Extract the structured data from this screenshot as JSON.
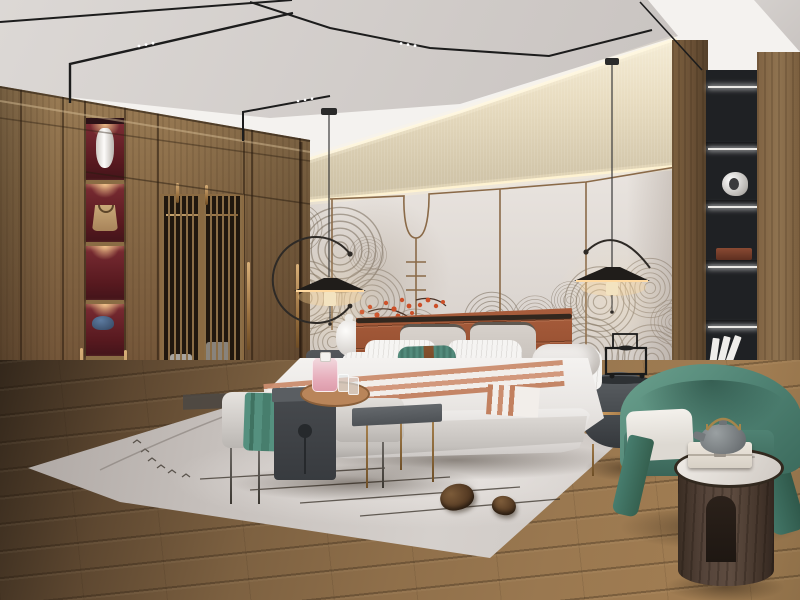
{
  "meta": {
    "domain": "Natural-Image",
    "scene": "Modern new-Chinese style bedroom interior rendering, wide-angle view",
    "no_visible_text": true
  },
  "labels": {
    "room": "Bedroom interior",
    "ceiling": "White and grey ceiling with black magnetic track lights and LED dots",
    "wardrobe": "Walnut wardrobe wall with lattice sliding doors and lit red display niche",
    "feature_wall": "Headboard feature wall: beige textured band, grey panels, brass trim with U-drop, wave mural",
    "right_shelf": "Black built-in display shelving with LED strips",
    "right_pillar": "Walnut wood pillar panels",
    "bed": "Upholstered platform bed with caramel leather channel headboard",
    "pillows": "Layered pillows: taupe, white pinstripe, teal lumbar with leather strap, white bolster",
    "runner": "Salmon and white striped bed runner",
    "nightstand_left": "Dark grey nightstand with white gourd vase lamp",
    "nightstand_right": "Oval dark grey nightstand with brass pull and black wire decor cart",
    "bench": "Bed-end bench with charcoal saddle tray table and C-shaped side table",
    "tray": "Round wood tray with pink perfume bottle and two glasses",
    "throw": "Teal folded throw",
    "armchair": "Teal green barrel armchair with white seat cushion",
    "side_table": "Dark walnut cylinder side table with marble top, keepsake box and grey teapot",
    "rug": "Greige area rug with arc motif, bird marks and twig lines",
    "floor": "Warm brown wood plank floor",
    "lamp_left": "Black disc pendant lamp with arc arm, left of bed",
    "lamp_right": "Black disc pendant lamp with arc arm, right of bed",
    "blossoms": "Red plum blossom branch on brass drop rod",
    "pinecones": "Two pine cones on rug"
  },
  "palette": {
    "ceiling_gray": "#cfcac7",
    "soffit_white": "#f4f2ef",
    "track_black": "#1c1c1c",
    "wallpaper_beige": "#e8dcc0",
    "panel_gray": "#ded8d3",
    "brass_trim": "#8a6a48",
    "mural_taupe": "#7b6e5f",
    "wardrobe_wood": "#8a6c48",
    "niche_red": "#57191f",
    "lattice_dark": "#221910",
    "shelf_black": "#1f2124",
    "headboard_leather": "#975031",
    "bedding_white": "#f0eeec",
    "teal_accent": "#4c8577",
    "runner_salmon": "#cb8d6e",
    "bench_gray": "#cfcbc7",
    "saddle_charcoal": "#46494d",
    "armchair_teal": "#4f8273",
    "cylinder_walnut": "#55443a",
    "marble_top": "#e9e5e0",
    "rug_greige": "#ccc6c2",
    "floor_wood": "#8f6f4a",
    "blossom_red": "#cc4f28"
  },
  "objects": {
    "niche_items": [
      "white vase",
      "tan handbag",
      "blue hat"
    ],
    "shelf_items": [
      "white abstract sculpture",
      "dark wood box",
      "leaning white books"
    ],
    "bench_items": [
      "round wood tray",
      "pink perfume bottle",
      "two glasses",
      "teal throw"
    ],
    "side_table_items": [
      "grey cast teapot with brass handle",
      "white marble box"
    ],
    "rug_items": [
      "large pine cone",
      "small pine cone"
    ]
  }
}
